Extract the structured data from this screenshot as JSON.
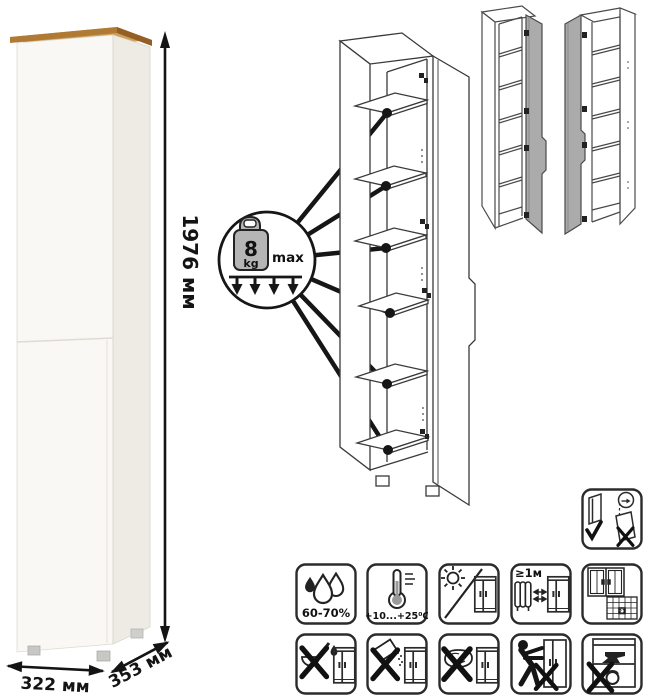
{
  "page": {
    "background": "#ffffff"
  },
  "product_photo": {
    "height_label": "1976 мм",
    "width_label": "322 мм",
    "depth_label": "353 мм",
    "colors": {
      "top_board_wood": "#b07a35",
      "top_board_wood_light": "#cfa05c",
      "body_front": "#f9f8f4",
      "body_side": "#edebe4",
      "dimension_line": "#141414"
    }
  },
  "shelf_load_callout": {
    "value": "8",
    "unit": "kg",
    "suffix": "max",
    "weight_fill": "#b5b5b5",
    "line_color": "#161616"
  },
  "care_icons": {
    "humidity_range": "60-70%",
    "temperature_range": "+10...+25⁰C",
    "heat_distance": "≥1м",
    "acclimatization_days": "21"
  },
  "icon_names": [
    "door-mounting-variants-icon",
    "humidity-icon",
    "temperature-icon",
    "no-direct-sunlight-icon",
    "heat-source-distance-icon",
    "ventilation-calendar-icon",
    "no-aggressive-liquids-icon",
    "no-abrasive-powder-icon",
    "no-wet-cleaning-icon",
    "no-pushing-icon",
    "no-overloading-icon"
  ]
}
